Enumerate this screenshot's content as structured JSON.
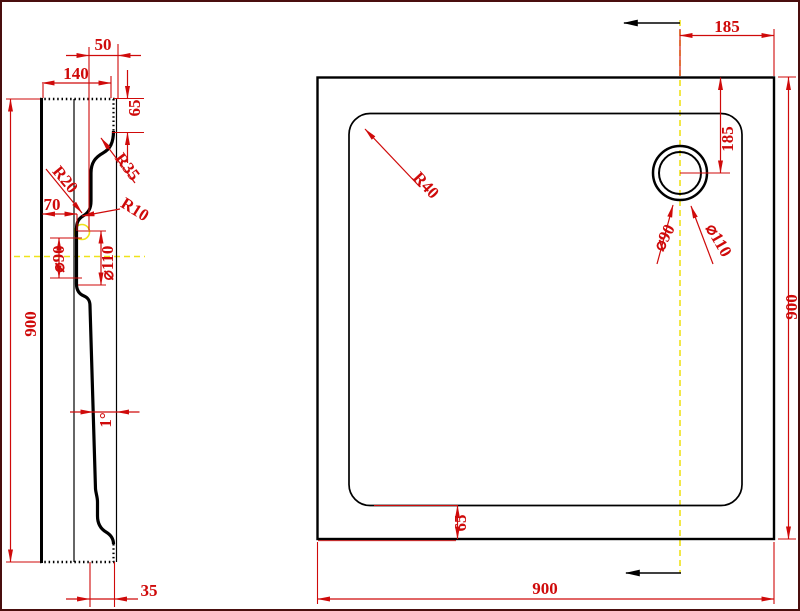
{
  "drawing": {
    "left_view": {
      "dims": {
        "width_top": "50",
        "width": "140",
        "rim_height": "65",
        "height": "900",
        "drain_offset": "70",
        "radius_r20": "R20",
        "radius_r35": "R35",
        "radius_r10": "R10",
        "drain_inner": "⌀90",
        "drain_outer": "⌀110",
        "draft_angle": "1°",
        "bottom_ledge": "35"
      }
    },
    "right_view": {
      "dims": {
        "drain_from_right": "185",
        "drain_from_top": "185",
        "height": "900",
        "width": "900",
        "rim": "65",
        "corner_radius": "R40",
        "drain_inner": "⌀90",
        "drain_outer": "⌀110"
      }
    },
    "colors": {
      "dimension_red": "#cf0a0a",
      "outline_black": "#000000",
      "centerline_yellow": "#efe319",
      "background": "#ffffff",
      "frame": "#4a0e0e"
    }
  }
}
